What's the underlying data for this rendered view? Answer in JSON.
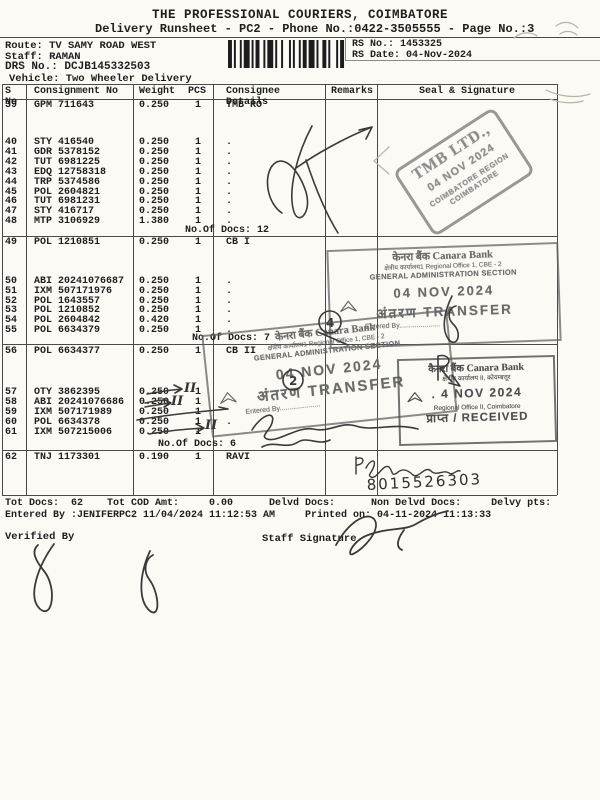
{
  "page": {
    "title": "THE PROFESSIONAL COURIERS, COIMBATORE",
    "subtitle": "Delivery Runsheet - PC2 - Phone No.:0422-3505555 - Page No.:3",
    "route": "Route: TV SAMY ROAD WEST",
    "staff": "Staff: RAMAN",
    "drs_no": "DRS No.: DCJB145332503",
    "vehicle": "Vehicle: Two Wheeler Delivery",
    "rs_no": "RS No.: 1453325",
    "rs_date": "RS Date: 04-Nov-2024"
  },
  "table": {
    "headers": [
      "S No",
      "Consignment No",
      "Weight",
      "PCS",
      "Consignee Details",
      "Remarks",
      "Seal & Signature"
    ],
    "groups": [
      {
        "rows": [
          {
            "sno": "39",
            "consignment": "GPM 711643",
            "weight": "0.250",
            "pcs": "1",
            "consignee": "TMB RO"
          },
          {
            "sno": "40",
            "consignment": "STY 416540",
            "weight": "0.250",
            "pcs": "1",
            "consignee": "."
          },
          {
            "sno": "41",
            "consignment": "GDR 5378152",
            "weight": "0.250",
            "pcs": "1",
            "consignee": "."
          },
          {
            "sno": "42",
            "consignment": "TUT 6981225",
            "weight": "0.250",
            "pcs": "1",
            "consignee": "."
          },
          {
            "sno": "43",
            "consignment": "EDQ 12758318",
            "weight": "0.250",
            "pcs": "1",
            "consignee": "."
          },
          {
            "sno": "44",
            "consignment": "TRP 5374586",
            "weight": "0.250",
            "pcs": "1",
            "consignee": "."
          },
          {
            "sno": "45",
            "consignment": "POL 2604821",
            "weight": "0.250",
            "pcs": "1",
            "consignee": "."
          },
          {
            "sno": "46",
            "consignment": "TUT 6981231",
            "weight": "0.250",
            "pcs": "1",
            "consignee": "."
          },
          {
            "sno": "47",
            "consignment": "STY 416717",
            "weight": "0.250",
            "pcs": "1",
            "consignee": "."
          },
          {
            "sno": "48",
            "consignment": "MTP 3106929",
            "weight": "1.380",
            "pcs": "1",
            "consignee": "."
          }
        ],
        "docs_note": "No.Of Docs: 12"
      },
      {
        "rows": [
          {
            "sno": "49",
            "consignment": "POL 1210851",
            "weight": "0.250",
            "pcs": "1",
            "consignee": "CB I"
          },
          {
            "sno": "50",
            "consignment": "ABI 20241076687",
            "weight": "0.250",
            "pcs": "1",
            "consignee": "."
          },
          {
            "sno": "51",
            "consignment": "IXM 507171976",
            "weight": "0.250",
            "pcs": "1",
            "consignee": "."
          },
          {
            "sno": "52",
            "consignment": "POL 1643557",
            "weight": "0.250",
            "pcs": "1",
            "consignee": "."
          },
          {
            "sno": "53",
            "consignment": "POL 1210852",
            "weight": "0.250",
            "pcs": "1",
            "consignee": "."
          },
          {
            "sno": "54",
            "consignment": "POL 2604842",
            "weight": "0.420",
            "pcs": "1",
            "consignee": "."
          },
          {
            "sno": "55",
            "consignment": "POL 6634379",
            "weight": "0.250",
            "pcs": "1",
            "consignee": "."
          }
        ],
        "docs_note": "No.Of Docs: 7"
      },
      {
        "rows": [
          {
            "sno": "56",
            "consignment": "POL 6634377",
            "weight": "0.250",
            "pcs": "1",
            "consignee": "CB II"
          },
          {
            "sno": "57",
            "consignment": "OTY 3862395",
            "weight": "0.250",
            "pcs": "1",
            "consignee": ""
          },
          {
            "sno": "58",
            "consignment": "ABI 20241076686",
            "weight": "0.250",
            "pcs": "1",
            "consignee": ""
          },
          {
            "sno": "59",
            "consignment": "IXM 507171989",
            "weight": "0.250",
            "pcs": "1",
            "consignee": ""
          },
          {
            "sno": "60",
            "consignment": "POL 6634378",
            "weight": "0.250",
            "pcs": "1",
            "consignee": "."
          },
          {
            "sno": "61",
            "consignment": "IXM 507215006",
            "weight": "0.250",
            "pcs": "1",
            "consignee": ""
          }
        ],
        "docs_note": "No.Of Docs: 6"
      },
      {
        "rows": [
          {
            "sno": "62",
            "consignment": "TNJ 1173301",
            "weight": "0.190",
            "pcs": "1",
            "consignee": "RAVI"
          }
        ],
        "docs_note": ""
      }
    ]
  },
  "stamps": {
    "tmb": {
      "line1": "TMB LTD.,",
      "date": "04 NOV 2024",
      "region": "COIMBATORE REGION",
      "city": "COIMBATORE"
    },
    "canara_transfer_1": {
      "bank_hi": "केनरा बैंक",
      "bank_en": "Canara Bank",
      "office": "क्षेत्रीय कार्यालय1 Regional Office 1, CBE - 2",
      "section": "GENERAL ADMINISTRATION SECTION",
      "date": "04 NOV 2024",
      "action_hi": "अंतरण",
      "action_en": "TRANSFER",
      "entered": "Entered By....................."
    },
    "canara_transfer_2": {
      "bank_hi": "केनरा बैंक",
      "bank_en": "Canara Bank",
      "office": "क्षेत्रीय कार्यालय1 Regional Office 1, CBE - 2",
      "section": "GENERAL ADMINISTRATION SECTION",
      "date": "04 NOV 2024",
      "action_hi": "अंतरण",
      "action_en": "TRANSFER",
      "entered": "Entered By....................."
    },
    "canara_received": {
      "bank_hi": "कैनरा बैंक",
      "bank_en": "Canara Bank",
      "office": "क्षेत्रीय कार्यालय II, कोयम्बत्तूर",
      "date": ". 4 NOV 2024",
      "office_en": "Regional Office II, Coimbatore",
      "action": "प्राप्त / RECEIVED"
    }
  },
  "handwriting": {
    "phone": "8015526303",
    "roman_marks": [
      "II",
      "II",
      "II"
    ],
    "circled_digits": [
      "4",
      "2"
    ]
  },
  "footer": {
    "totals": "Tot Docs:  62    Tot COD Amt:     0.00      Delvd Docs:      Non Delvd Docs:     Delvy pts:",
    "entered": "Entered By :JENIFERPC2 11/04/2024 11:12:53 AM     Printed on: 04-11-2024 11:13:33",
    "verified_by": "Verified By",
    "staff_signature": "Staff Signature"
  },
  "colors": {
    "paper": "#fbfaf5",
    "ink": "#1e1e1e",
    "tmb_stamp": "#8d8d8d",
    "canara_stamp": "#6a6a6a",
    "received_stamp": "#4f4f4f",
    "pen": "#3a3a3a",
    "pencil": "#b9b2a6"
  }
}
